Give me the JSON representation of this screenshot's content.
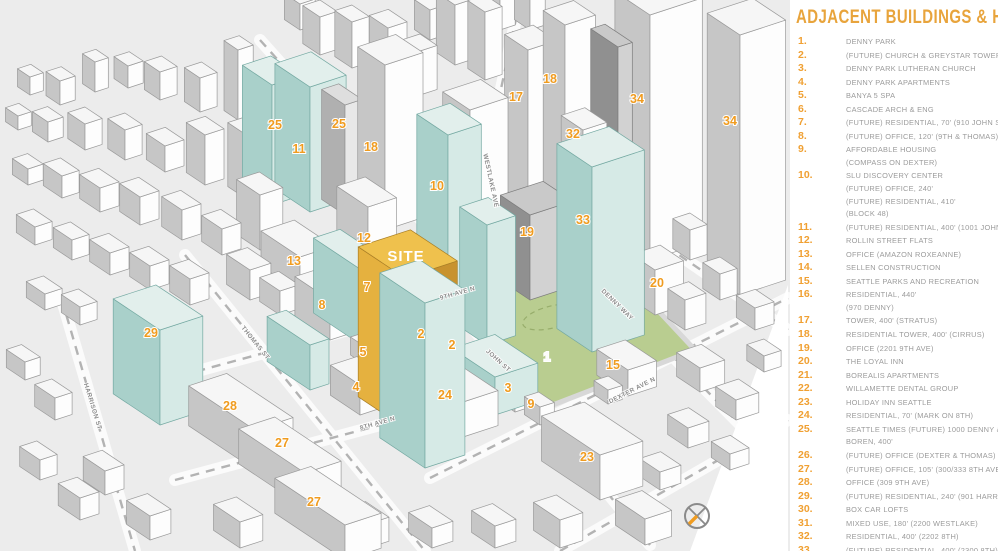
{
  "legend": {
    "title": "ADJACENT BUILDINGS & HEIGHTS",
    "items": [
      {
        "num": "1.",
        "lines": [
          "DENNY PARK"
        ]
      },
      {
        "num": "2.",
        "lines": [
          "(FUTURE) CHURCH & GREYSTAR TOWER, 280'"
        ]
      },
      {
        "num": "3.",
        "lines": [
          "DENNY PARK LUTHERAN CHURCH"
        ]
      },
      {
        "num": "4.",
        "lines": [
          "DENNY PARK APARTMENTS"
        ]
      },
      {
        "num": "5.",
        "lines": [
          "BANYA 5 SPA"
        ]
      },
      {
        "num": "6.",
        "lines": [
          "CASCADE ARCH & ENG"
        ]
      },
      {
        "num": "7.",
        "lines": [
          "(FUTURE) RESIDENTIAL, 70' (910 JOHN ST)"
        ]
      },
      {
        "num": "8.",
        "lines": [
          "(FUTURE) OFFICE, 120' (9TH & THOMAS)"
        ]
      },
      {
        "num": "9.",
        "lines": [
          "AFFORDABLE HOUSING",
          "(COMPASS ON DEXTER)"
        ]
      },
      {
        "num": "10.",
        "lines": [
          "SLU DISCOVERY CENTER",
          "(FUTURE) OFFICE, 240'",
          "(FUTURE) RESIDENTIAL, 410'",
          "(BLOCK 48)"
        ]
      },
      {
        "num": "11.",
        "lines": [
          "(FUTURE) RESIDENTIAL, 400' (1001 JOHN ST)"
        ]
      },
      {
        "num": "12.",
        "lines": [
          "ROLLIN STREET FLATS"
        ]
      },
      {
        "num": "13.",
        "lines": [
          "OFFICE (AMAZON ROXEANNE)"
        ]
      },
      {
        "num": "14.",
        "lines": [
          "SELLEN CONSTRUCTION"
        ]
      },
      {
        "num": "15.",
        "lines": [
          "SEATTLE PARKS AND RECREATION"
        ]
      },
      {
        "num": "16.",
        "lines": [
          "RESIDENTIAL, 440'",
          "(970 DENNY)"
        ]
      },
      {
        "num": "17.",
        "lines": [
          "TOWER, 400' (STRATUS)"
        ]
      },
      {
        "num": "18.",
        "lines": [
          "RESIDENTIAL TOWER, 400' (CIRRUS)"
        ]
      },
      {
        "num": "19.",
        "lines": [
          "OFFICE (2201 9TH AVE)"
        ]
      },
      {
        "num": "20.",
        "lines": [
          "THE LOYAL INN"
        ]
      },
      {
        "num": "21.",
        "lines": [
          "BOREALIS APARTMENTS"
        ]
      },
      {
        "num": "22.",
        "lines": [
          "WILLAMETTE DENTAL GROUP"
        ]
      },
      {
        "num": "23.",
        "lines": [
          "HOLIDAY INN SEATTLE"
        ]
      },
      {
        "num": "24.",
        "lines": [
          "RESIDENTIAL, 70' (MARK ON 8TH)"
        ]
      },
      {
        "num": "25.",
        "lines": [
          "SEATTLE TIMES (FUTURE) 1000 DENNY & 121",
          "BOREN, 400'"
        ]
      },
      {
        "num": "26.",
        "lines": [
          "(FUTURE) OFFICE (DEXTER & THOMAS)"
        ]
      },
      {
        "num": "27.",
        "lines": [
          "(FUTURE) OFFICE, 105' (300/333 8TH AVE)"
        ]
      },
      {
        "num": "28.",
        "lines": [
          "OFFICE (309 9TH AVE)"
        ]
      },
      {
        "num": "29.",
        "lines": [
          "(FUTURE) RESIDENTIAL, 240' (901 HARRISON)"
        ]
      },
      {
        "num": "30.",
        "lines": [
          "BOX CAR LOFTS"
        ]
      },
      {
        "num": "31.",
        "lines": [
          "MIXED USE, 180' (2200 WESTLAKE)"
        ]
      },
      {
        "num": "32.",
        "lines": [
          "RESIDENTIAL, 400' (2202 8TH)"
        ]
      },
      {
        "num": "33.",
        "lines": [
          "(FUTURE) RESIDENTIAL, 400' (2300 8TH)"
        ]
      },
      {
        "num": "34.",
        "lines": [
          "AMAZON RUFUS OFFICE, 500'"
        ]
      }
    ]
  },
  "map": {
    "site_label": "SITE",
    "number_labels": [
      {
        "text": "25",
        "x": 275,
        "y": 125
      },
      {
        "text": "11",
        "x": 299,
        "y": 149
      },
      {
        "text": "25",
        "x": 339,
        "y": 124
      },
      {
        "text": "18",
        "x": 371,
        "y": 147
      },
      {
        "text": "10",
        "x": 437,
        "y": 186
      },
      {
        "text": "12",
        "x": 364,
        "y": 238
      },
      {
        "text": "13",
        "x": 294,
        "y": 261
      },
      {
        "text": "7",
        "x": 367,
        "y": 287
      },
      {
        "text": "8",
        "x": 322,
        "y": 305
      },
      {
        "text": "5",
        "x": 363,
        "y": 352
      },
      {
        "text": "2",
        "x": 421,
        "y": 334
      },
      {
        "text": "2",
        "x": 452,
        "y": 345
      },
      {
        "text": "4",
        "x": 356,
        "y": 387
      },
      {
        "text": "24",
        "x": 445,
        "y": 395
      },
      {
        "text": "3",
        "x": 508,
        "y": 388
      },
      {
        "text": "9",
        "x": 531,
        "y": 404
      },
      {
        "text": "1",
        "x": 547,
        "y": 357,
        "white": true
      },
      {
        "text": "15",
        "x": 613,
        "y": 365
      },
      {
        "text": "20",
        "x": 657,
        "y": 283
      },
      {
        "text": "23",
        "x": 587,
        "y": 457
      },
      {
        "text": "19",
        "x": 527,
        "y": 232
      },
      {
        "text": "17",
        "x": 516,
        "y": 97
      },
      {
        "text": "18",
        "x": 550,
        "y": 79
      },
      {
        "text": "34",
        "x": 637,
        "y": 99
      },
      {
        "text": "34",
        "x": 730,
        "y": 121
      },
      {
        "text": "32",
        "x": 573,
        "y": 134
      },
      {
        "text": "33",
        "x": 583,
        "y": 220
      },
      {
        "text": "29",
        "x": 151,
        "y": 333
      },
      {
        "text": "28",
        "x": 230,
        "y": 406
      },
      {
        "text": "27",
        "x": 282,
        "y": 443
      },
      {
        "text": "27",
        "x": 314,
        "y": 502
      }
    ],
    "street_labels": [
      {
        "text": "WESTLAKE AVE",
        "x": 489,
        "y": 181,
        "rotate": 78
      },
      {
        "text": "9TH AVE N",
        "x": 458,
        "y": 295,
        "rotate": -16
      },
      {
        "text": "8TH AVE N",
        "x": 378,
        "y": 425,
        "rotate": -16
      },
      {
        "text": "DEXTER AVE N",
        "x": 633,
        "y": 392,
        "rotate": -27
      },
      {
        "text": "THOMAS ST",
        "x": 254,
        "y": 344,
        "rotate": 51
      },
      {
        "text": "HARRISON ST",
        "x": 91,
        "y": 407,
        "rotate": 73
      },
      {
        "text": "JOHN ST",
        "x": 497,
        "y": 362,
        "rotate": 42
      },
      {
        "text": "DENNY WAY",
        "x": 616,
        "y": 306,
        "rotate": 44
      }
    ],
    "compass_icon": "north-compass"
  },
  "colors": {
    "accent_orange": "#f09c20",
    "legend_title_orange": "#e8a43c",
    "legend_text_gray": "#9b9b9b",
    "park_green": "#b9cd90",
    "glass_cyan": "#d6eae6",
    "site_yellow": "#efc14d",
    "ground_gray": "#ececec"
  }
}
